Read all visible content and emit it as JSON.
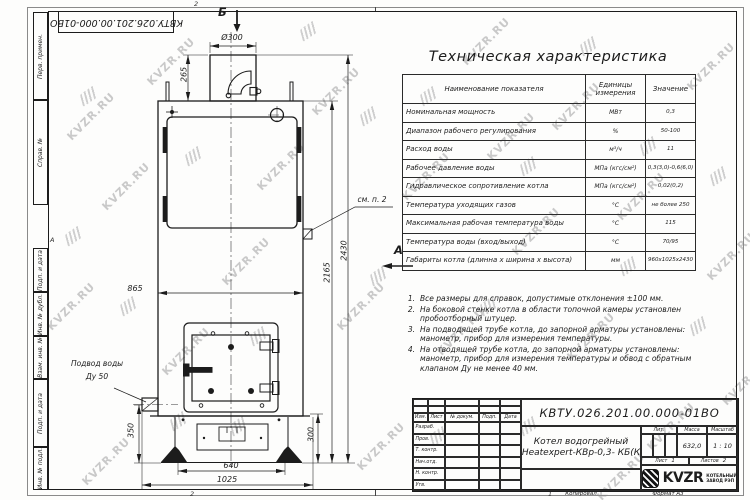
{
  "watermark": {
    "text": "KVZR.RU"
  },
  "frame": {
    "top_doc_number": "КВТУ.026.201.00.000-01ВО",
    "left_labels": [
      "Перв. примен.",
      "Справ. №",
      "Подп. и дата",
      "Инв. № дубл.",
      "Взам. инв. №",
      "Подп. и дата",
      "Инв. № подл."
    ],
    "zone_marker_left": "А",
    "zone_top": "2",
    "zone_bottom_left": "2",
    "zone_bottom_right": "1",
    "kopiroval": "Копировал",
    "format": "Формат А3"
  },
  "drawing": {
    "view_b": "Б",
    "view_a": "А",
    "callout_see_note": "см. п. 2",
    "water_inlet_line1": "Подвод воды",
    "water_inlet_line2": "Ду 50",
    "dims": {
      "d300": "Ø300",
      "h265": "265",
      "h2430": "2430",
      "h2165": "2165",
      "w865": "865",
      "h350": "350",
      "h300": "300",
      "w640": "640",
      "w1025": "1025"
    }
  },
  "spec_table": {
    "title": "Техническая характеристика",
    "headers": [
      "Наименование показателя",
      "Единицы измерения",
      "Значение"
    ],
    "rows": [
      [
        "Номинальная мощность",
        "МВт",
        "0,3"
      ],
      [
        "Диапазон рабочего регулирования",
        "%",
        "50-100"
      ],
      [
        "Расход воды",
        "м³/ч",
        "11"
      ],
      [
        "Рабочее давление воды",
        "МПа (кгс/см²)",
        "0,3(3,0)-0,6(6,0)"
      ],
      [
        "Гидравлическое сопротивление котла",
        "МПа (кгс/см²)",
        "0,02(0,2)"
      ],
      [
        "Температура уходящих газов",
        "°С",
        "не более 250"
      ],
      [
        "Максимальная рабочая температура воды",
        "°С",
        "115"
      ],
      [
        "Температура воды (вход/выход)",
        "°С",
        "70/95"
      ],
      [
        "Габариты котла (длинна x ширина x высота)",
        "мм",
        "960x1025x2430"
      ]
    ]
  },
  "notes": {
    "items": [
      "Все размеры для справок, допустимые отклонения ±100 мм.",
      "На боковой стенке котла в области топочной камеры установлен пробоотборный штуцер.",
      "На подводящей трубе котла, до запорной арматуры установлены: манометр, прибор для измерения температуры.",
      "На отводящей трубе котла, до запорной арматуры установлены: манометр, прибор для измерения температуры и обвод с обратным клапаном Ду не менее 40 мм."
    ]
  },
  "title_block": {
    "doc_number": "КВТУ.026.201.00.000-01ВО",
    "product_name_line1": "Котел водогрейный",
    "product_name_line2": "Heatexpert-КВр-0,3- КБ(К",
    "header_cols": [
      "Изм.",
      "Лист",
      "№ докум.",
      "Подп.",
      "Дата"
    ],
    "sign_rows": [
      "Разраб.",
      "Пров.",
      "Т. контр.",
      "Нач.отд.",
      "Н. контр.",
      "Утв."
    ],
    "lit_label": "Лит.",
    "mass_label": "Масса",
    "scale_label": "Масштаб",
    "mass": "632,0",
    "scale": "1 : 10",
    "sheet_label": "Лист",
    "sheet": "1",
    "sheets_label": "Листов",
    "sheets": "2",
    "logo_brand": "KVZR",
    "logo_sub1": "КОТЕЛЬНЫЙ",
    "logo_sub2": "ЗАВОД РЭП"
  }
}
